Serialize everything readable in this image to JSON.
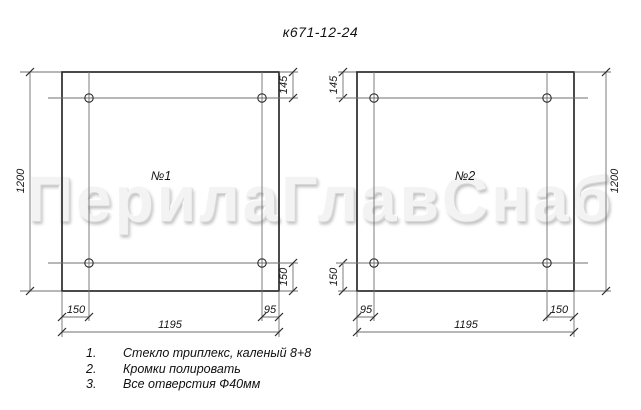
{
  "page": {
    "title": "к671-12-24",
    "watermark": "ПерилаГлавСнаб"
  },
  "panels": [
    {
      "label": "№1",
      "dims": {
        "height": "1200",
        "width": "1195",
        "top_hole_offset": "145",
        "bottom_hole_offset": "150",
        "left_hole_offset": "150",
        "right_hole_offset": "95"
      }
    },
    {
      "label": "№2",
      "dims": {
        "height": "1200",
        "width": "1195",
        "top_hole_offset": "145",
        "bottom_hole_offset": "150",
        "left_hole_offset": "95",
        "right_hole_offset": "150"
      }
    }
  ],
  "notes": [
    {
      "num": "1.",
      "text": "Стекло триплекс, каленый 8+8"
    },
    {
      "num": "2.",
      "text": "Кромки полировать"
    },
    {
      "num": "3.",
      "text": "Все отверстия Ф40мм"
    }
  ],
  "hole_note": "Ф40мм",
  "colors": {
    "edge_line": "#2b2b2b",
    "thin_line": "#6f6f6f",
    "text": "#161616",
    "watermark": "#f3f3f3",
    "background": "#ffffff"
  }
}
